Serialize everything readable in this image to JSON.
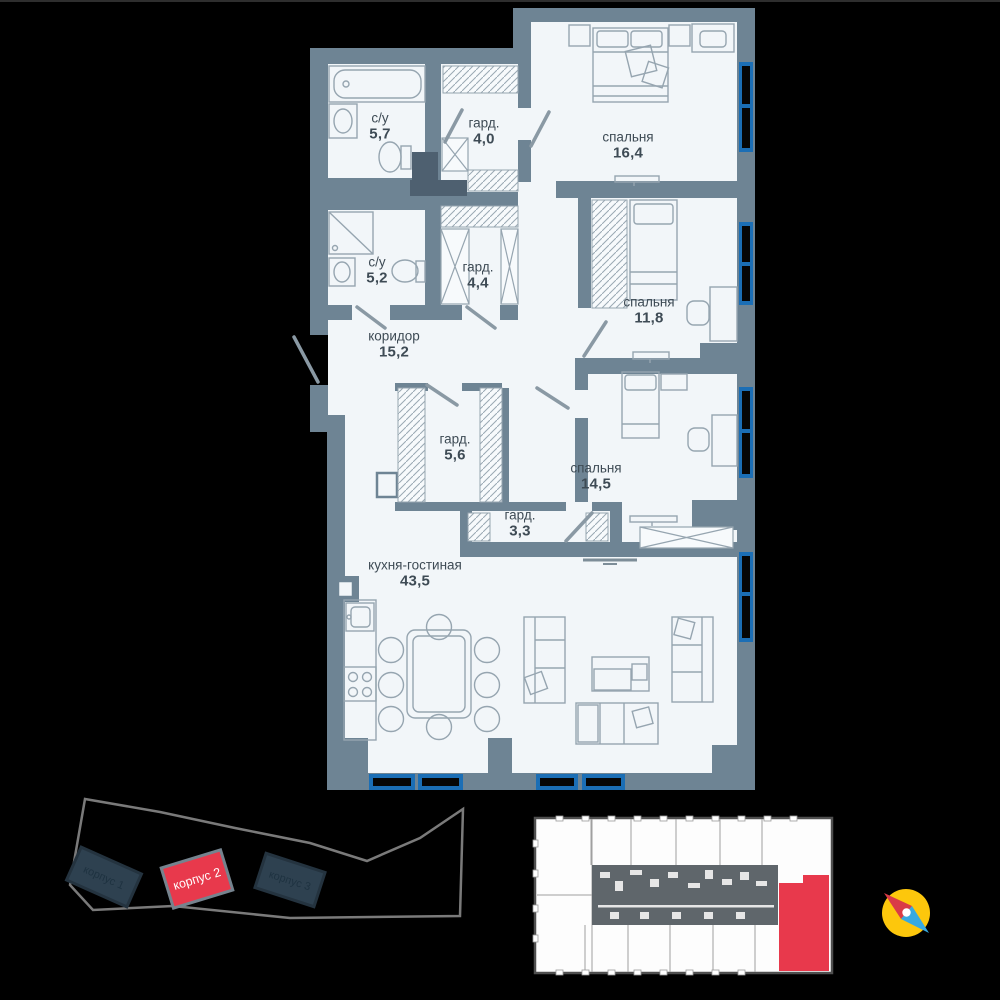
{
  "palette": {
    "background": "#000000",
    "wall": "#6e8494",
    "wall_dark_shaft": "#4e6070",
    "floor": "#f2f6f9",
    "furniture_line": "#96a5b0",
    "window_blue": "#1b6eb5",
    "window_glass": "#060606",
    "label_text": "#3e4b55",
    "accent_red": "#e8394c",
    "dark_building": "#2e4150",
    "site_outline": "#7a7a7a",
    "overview_outline": "#4f4f4f",
    "compass_yellow": "#fdc70c",
    "compass_red": "#d93b47",
    "compass_blue": "#36a9e1"
  },
  "floor_plan": {
    "rooms": [
      {
        "id": "bathroom-1",
        "name": "с/у",
        "area": "5,7"
      },
      {
        "id": "wardrobe-1",
        "name": "гард.",
        "area": "4,0"
      },
      {
        "id": "bedroom-1",
        "name": "спальня",
        "area": "16,4"
      },
      {
        "id": "bathroom-2",
        "name": "с/у",
        "area": "5,2"
      },
      {
        "id": "wardrobe-2",
        "name": "гард.",
        "area": "4,4"
      },
      {
        "id": "bedroom-2",
        "name": "спальня",
        "area": "11,8"
      },
      {
        "id": "corridor",
        "name": "коридор",
        "area": "15,2"
      },
      {
        "id": "wardrobe-3",
        "name": "гард.",
        "area": "5,6"
      },
      {
        "id": "bedroom-3",
        "name": "спальня",
        "area": "14,5"
      },
      {
        "id": "wardrobe-4",
        "name": "гард.",
        "area": "3,3"
      },
      {
        "id": "kitchen-living",
        "name": "кухня-гостиная",
        "area": "43,5"
      }
    ]
  },
  "site_plan": {
    "buildings": [
      {
        "label": "корпус 1",
        "highlighted": false
      },
      {
        "label": "корпус 2",
        "highlighted": true
      },
      {
        "label": "корпус 3",
        "highlighted": false
      }
    ]
  },
  "floor_overview": {
    "highlighted_unit_color": "#e8394c"
  }
}
